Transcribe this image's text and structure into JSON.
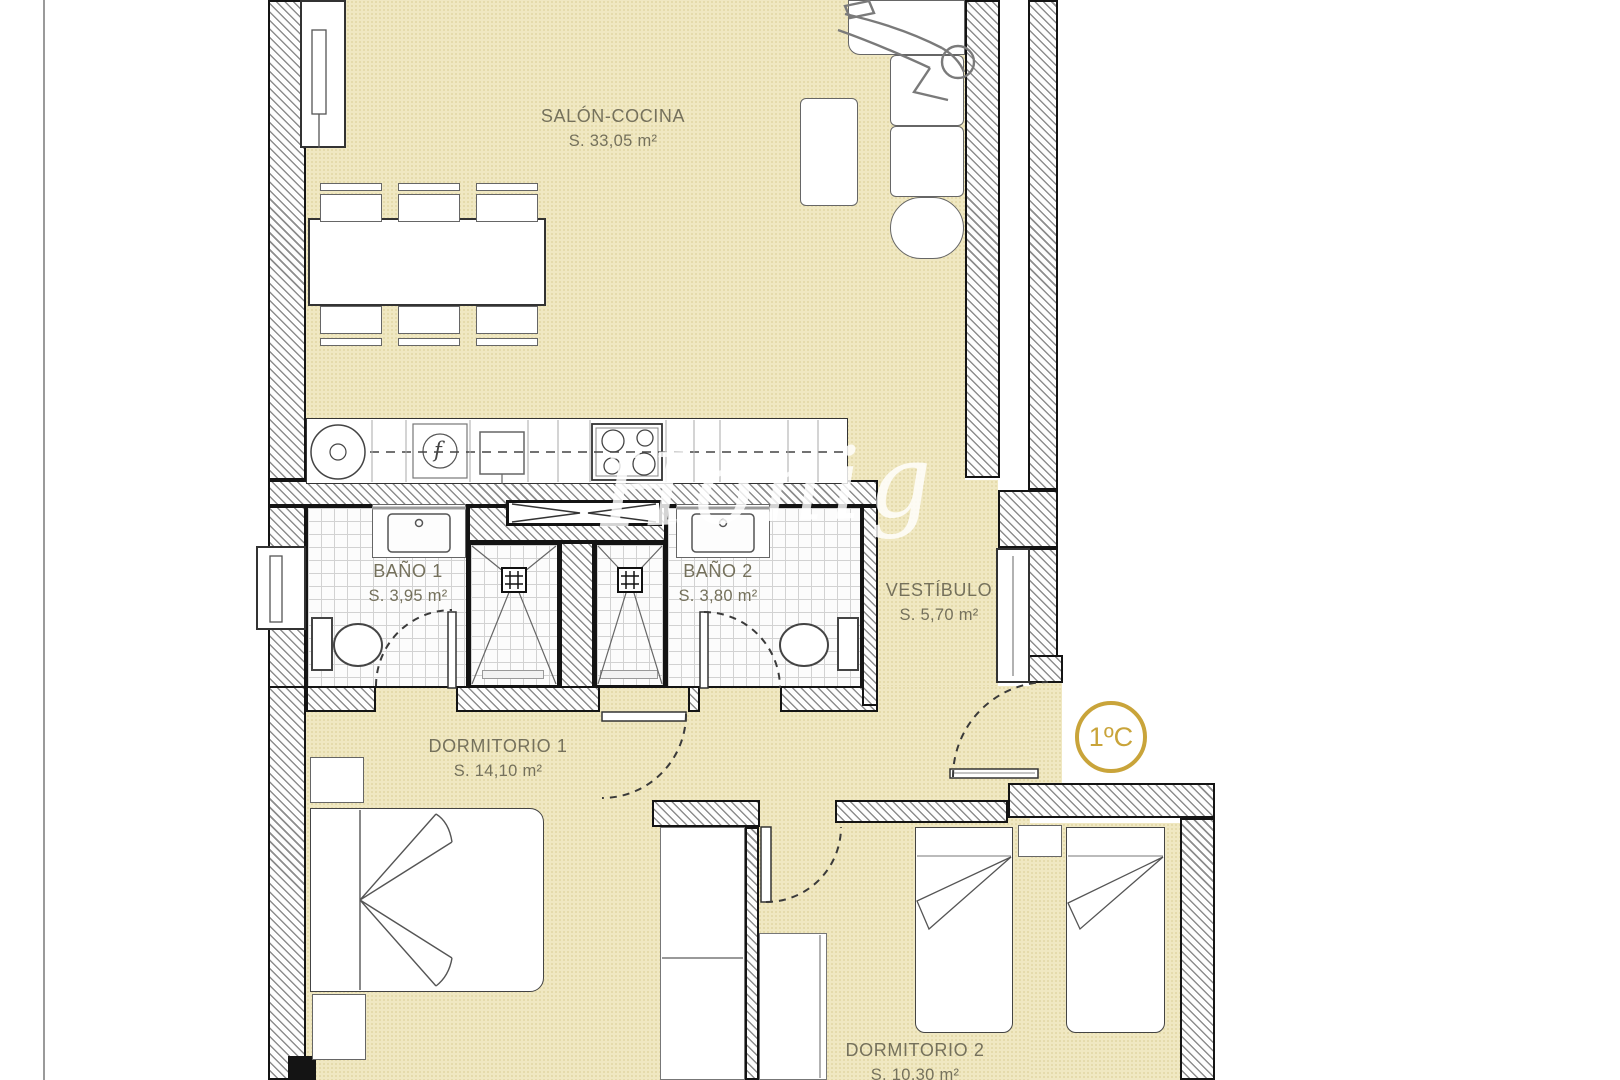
{
  "watermark": {
    "text": "Honig"
  },
  "unit_badge": {
    "label": "1ºC",
    "color": "#c9a43a"
  },
  "icons": {
    "appliance_f": "f"
  },
  "rooms": {
    "salon": {
      "name": "SALÓN-COCINA",
      "area": "S. 33,05 m²"
    },
    "bano1": {
      "name": "BAÑO 1",
      "area": "S. 3,95 m²"
    },
    "bano2": {
      "name": "BAÑO 2",
      "area": "S. 3,80 m²"
    },
    "vestibulo": {
      "name": "VESTÍBULO",
      "area": "S. 5,70 m²"
    },
    "dormitorio1": {
      "name": "DORMITORIO 1",
      "area": "S. 14,10 m²"
    },
    "dormitorio2": {
      "name": "DORMITORIO 2",
      "area": "S. 10,30 m²"
    }
  },
  "colors": {
    "floor": "#f0e8c2",
    "gold": "#c9a43a",
    "label_text": "#75715c"
  }
}
